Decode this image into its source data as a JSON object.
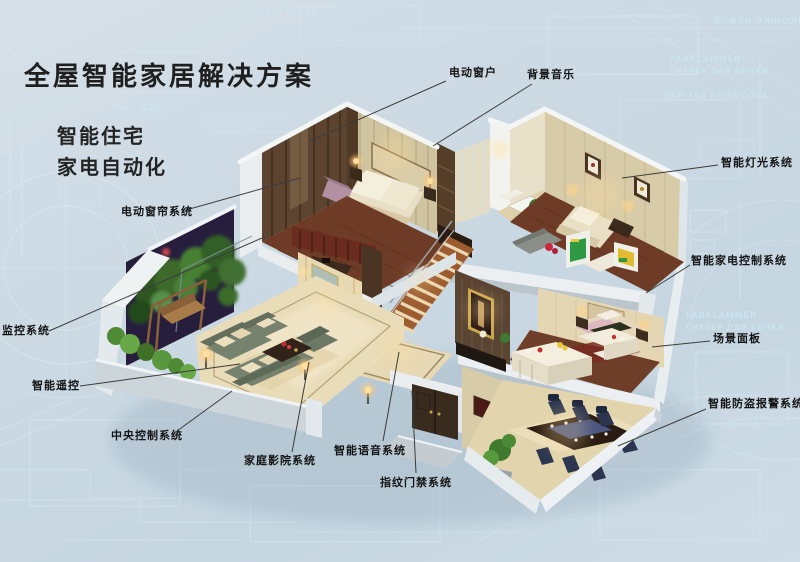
{
  "page": {
    "background_color": "#cbd9e3",
    "blueprint_line_color": "#dff2f8",
    "label_text_color": "#141414",
    "leader_line_color": "#3c3c3c"
  },
  "header": {
    "title": "全屋智能家居解决方案",
    "subtitle_line1": "智能住宅",
    "subtitle_line2": "家电自动化"
  },
  "labels": [
    {
      "id": "electric-window",
      "text": "电动窗户",
      "x": 449,
      "y": 64,
      "line": [
        446,
        81,
        310,
        141
      ]
    },
    {
      "id": "background-music",
      "text": "背景音乐",
      "x": 527,
      "y": 66,
      "line": [
        532,
        84,
        433,
        146
      ]
    },
    {
      "id": "smart-lighting-system",
      "text": "智能灯光系统",
      "x": 721,
      "y": 154,
      "line": [
        718,
        165,
        622,
        178
      ]
    },
    {
      "id": "smart-appliance-control-system",
      "text": "智能家电控制系统",
      "x": 691,
      "y": 252,
      "line": [
        690,
        265,
        646,
        293
      ]
    },
    {
      "id": "scene-panel",
      "text": "场景面板",
      "x": 713,
      "y": 330,
      "line": [
        710,
        341,
        652,
        347
      ]
    },
    {
      "id": "burglar-alarm-system",
      "text": "智能防盗报警系统",
      "x": 708,
      "y": 395,
      "line": [
        706,
        409,
        618,
        446
      ]
    },
    {
      "id": "electric-curtain-system",
      "text": "电动窗帘系统",
      "x": 121,
      "y": 203,
      "line": [
        186,
        210,
        300,
        178
      ]
    },
    {
      "id": "monitoring-system",
      "text": "监控系统",
      "x": 2,
      "y": 322,
      "line": [
        49,
        331,
        262,
        238
      ]
    },
    {
      "id": "smart-remote-control",
      "text": "智能遥控",
      "x": 32,
      "y": 377,
      "line": [
        80,
        386,
        240,
        364
      ]
    },
    {
      "id": "central-control-system",
      "text": "中央控制系统",
      "x": 111,
      "y": 427,
      "line": [
        177,
        431,
        232,
        391
      ]
    },
    {
      "id": "home-theater-system",
      "text": "家庭影院系统",
      "x": 244,
      "y": 452,
      "line": [
        292,
        452,
        309,
        362
      ]
    },
    {
      "id": "smart-voice-system",
      "text": "智能语音系统",
      "x": 334,
      "y": 442,
      "line": [
        383,
        441,
        399,
        352
      ]
    },
    {
      "id": "fingerprint-access-system",
      "text": "指纹门禁系统",
      "x": 380,
      "y": 474,
      "line": [
        416,
        473,
        412,
        391
      ]
    }
  ],
  "background": {
    "watermarks": [
      {
        "text": "ВОИЛИ ЭЖИОЛИ",
        "x": 714,
        "y": 24,
        "size": 9
      },
      {
        "text": "FABKLAMMER",
        "x": 670,
        "y": 62,
        "size": 9
      },
      {
        "text": "ГИРБЕР ДЛЯ БОЧКИ",
        "x": 670,
        "y": 74,
        "size": 8
      },
      {
        "text": "ЗОЖ-FAB ЛЮНБОЛКА",
        "x": 662,
        "y": 98,
        "size": 8
      },
      {
        "text": "min. 820",
        "x": 113,
        "y": 110,
        "size": 9
      },
      {
        "text": "max. Ø 565",
        "x": 256,
        "y": 14,
        "size": 9
      },
      {
        "text": "FABKLAMMER",
        "x": 686,
        "y": 318,
        "size": 9
      },
      {
        "text": "ГИРБЕР ДЛЯ БОЧКИ",
        "x": 686,
        "y": 330,
        "size": 8
      },
      {
        "text": "А — А",
        "x": 728,
        "y": 428,
        "size": 9
      },
      {
        "text": "а — а",
        "x": 6,
        "y": 52,
        "size": 9
      }
    ]
  }
}
